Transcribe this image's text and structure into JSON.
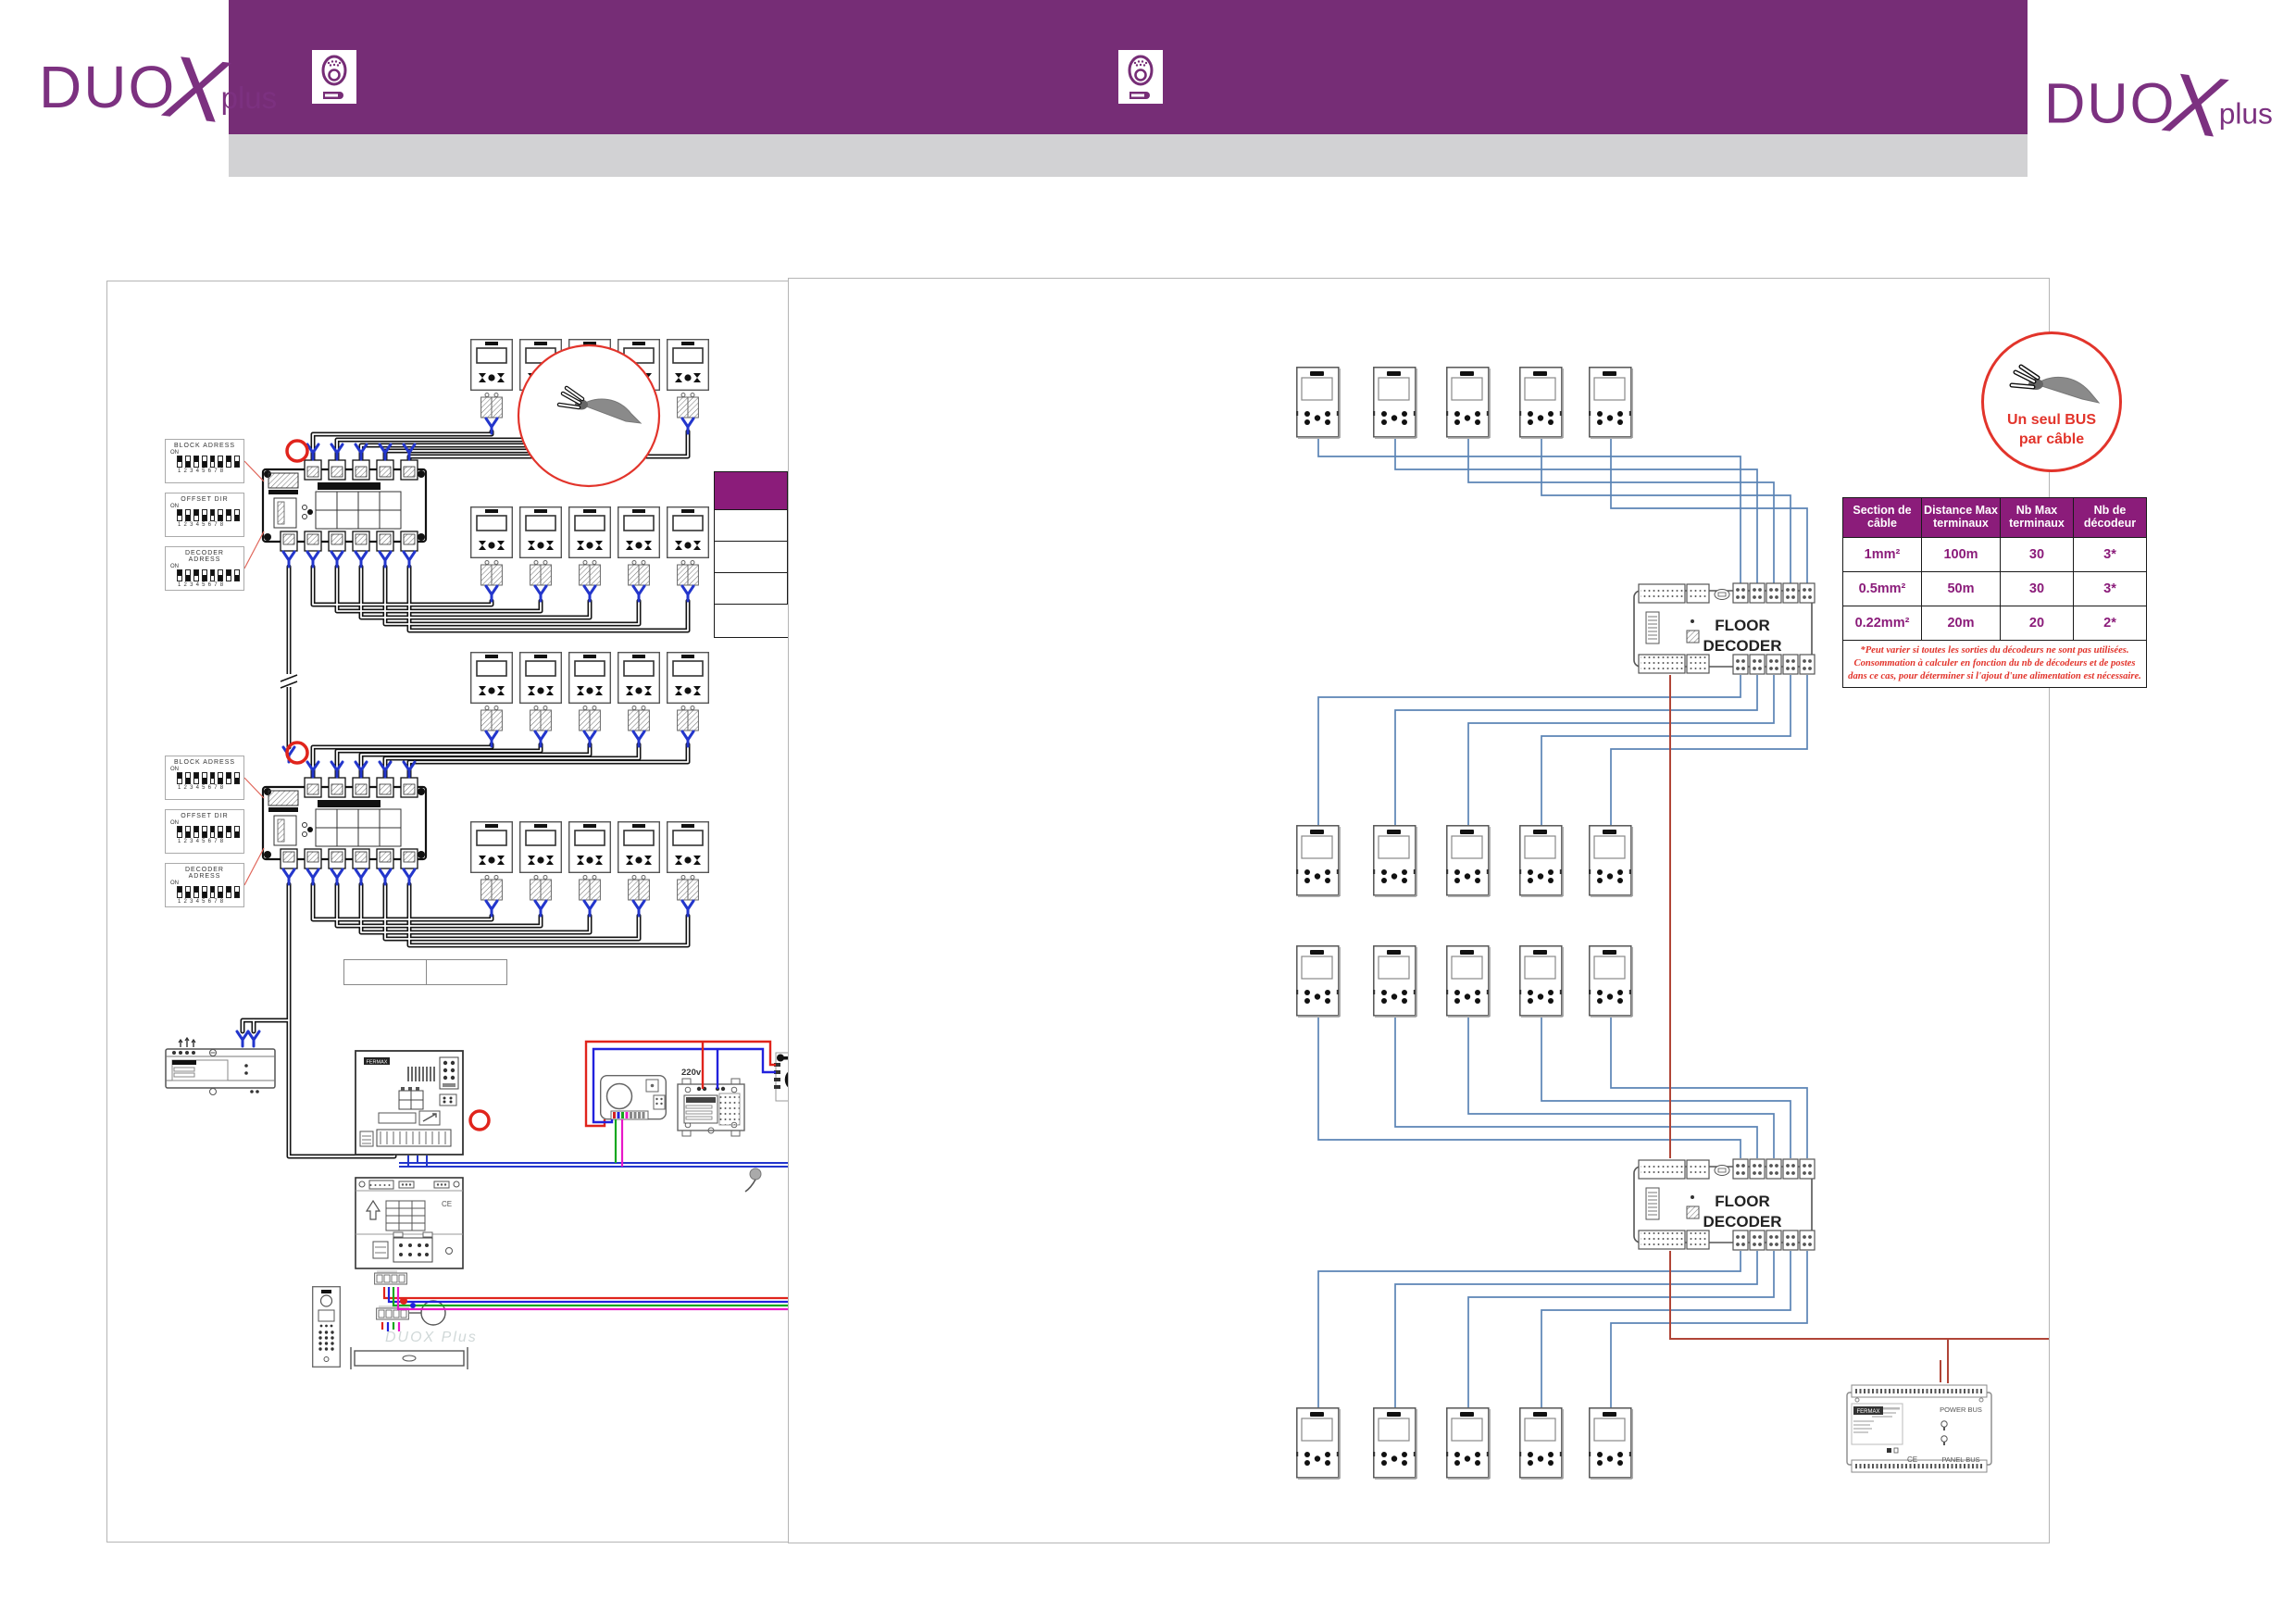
{
  "header": {
    "brand": {
      "duo": "DUO",
      "x": "X",
      "plus": "plus"
    },
    "icons": [
      "entry-panel-icon",
      "entry-panel-icon"
    ]
  },
  "left_diagram": {
    "dip_switch_labels": [
      "BLOCK ADRESS",
      "OFFSET DIR",
      "DECODER ADRESS"
    ],
    "dip_on_label": "ON",
    "dip_numbers": "12345678",
    "psu_220_label": "220v",
    "bloc_label": "BLOC GSM",
    "guard_unit_brand": "FERMAX",
    "ce_mark": "CE",
    "watermark": "DUOX Plus",
    "spec_table": {
      "columns": [
        "",
        "",
        "",
        ""
      ],
      "rows": [
        [
          "",
          "",
          "",
          ""
        ],
        [
          "",
          "",
          "",
          ""
        ],
        [
          "",
          "",
          "",
          ""
        ]
      ],
      "footer": ""
    }
  },
  "right_diagram": {
    "floor_decoder": {
      "line1": "FLOOR",
      "line2": "DECODER"
    },
    "bus_badge": {
      "line1": "Un seul BUS",
      "line2": "par câble"
    },
    "cable_table": {
      "headers": [
        "Section de câble",
        "Distance Max terminaux",
        "Nb Max terminaux",
        "Nb de décodeur"
      ],
      "rows": [
        [
          "1mm²",
          "100m",
          "30",
          "3*"
        ],
        [
          "0.5mm²",
          "50m",
          "30",
          "3*"
        ],
        [
          "0.22mm²",
          "20m",
          "20",
          "2*"
        ]
      ],
      "footnote_lines": [
        "*Peut varier si toutes les sorties du décodeurs ne sont pas utilisées.",
        "Consommation à calculer en fonction du nb de décodeurs et de postes",
        "dans ce cas, pour déterminer si l'ajout d'une alimentation est nécessaire."
      ]
    },
    "power_supply": {
      "brand": "FERMAX",
      "label_top": "POWER BUS",
      "label_bottom": "PANEL BUS",
      "ce": "CE"
    },
    "entry_panel": {
      "brand": "FERMAX"
    }
  },
  "colors": {
    "banner_purple": "#762d76",
    "band_gray": "#d2d2d4",
    "table_header_purple": "#8b1c7a",
    "accent_red": "#e2342b",
    "wire_blue": "#5b84b5",
    "wire_red": "#b04537",
    "connector_blue": "#2336cc"
  }
}
